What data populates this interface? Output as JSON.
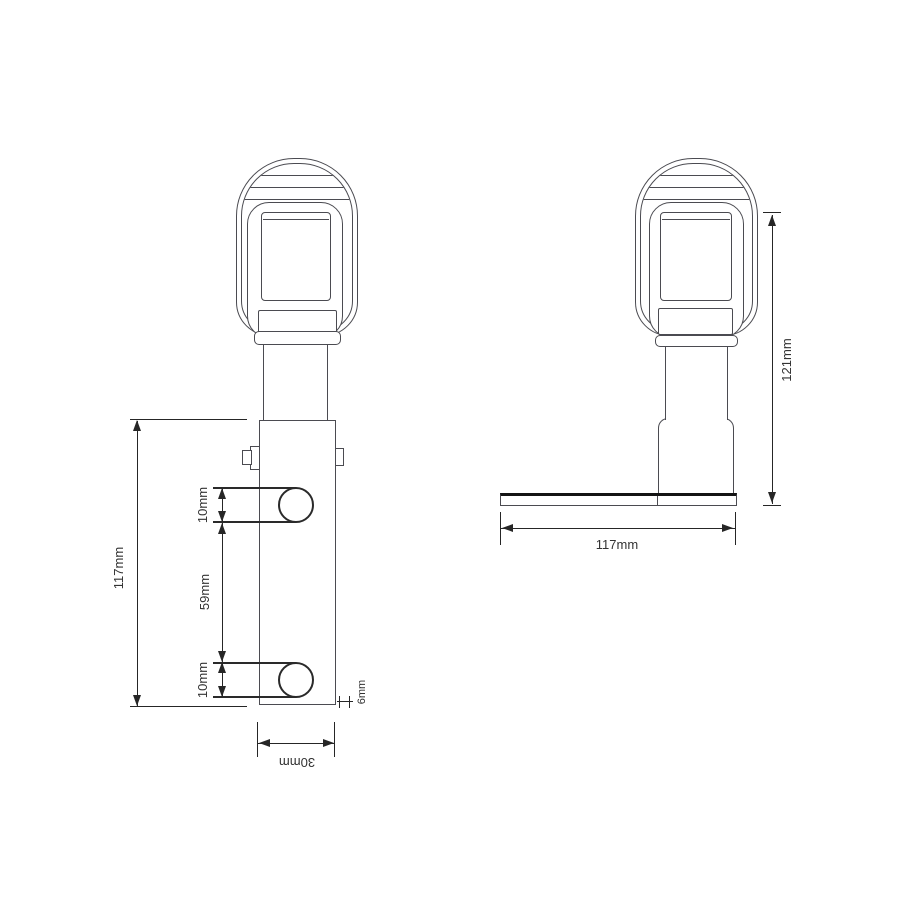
{
  "front_view": {
    "dimensions": {
      "overall_height": "117mm",
      "top_hole": "10mm",
      "hole_spacing": "59mm",
      "bottom_hole": "10mm",
      "bracket_width": "30mm",
      "plate_thickness": "6mm"
    }
  },
  "side_view": {
    "dimensions": {
      "overall_height": "121mm",
      "base_length": "117mm"
    }
  },
  "colors": {
    "outline": "#4b4b51",
    "dimension_line": "#262626",
    "text": "#333333",
    "background": "#ffffff"
  }
}
